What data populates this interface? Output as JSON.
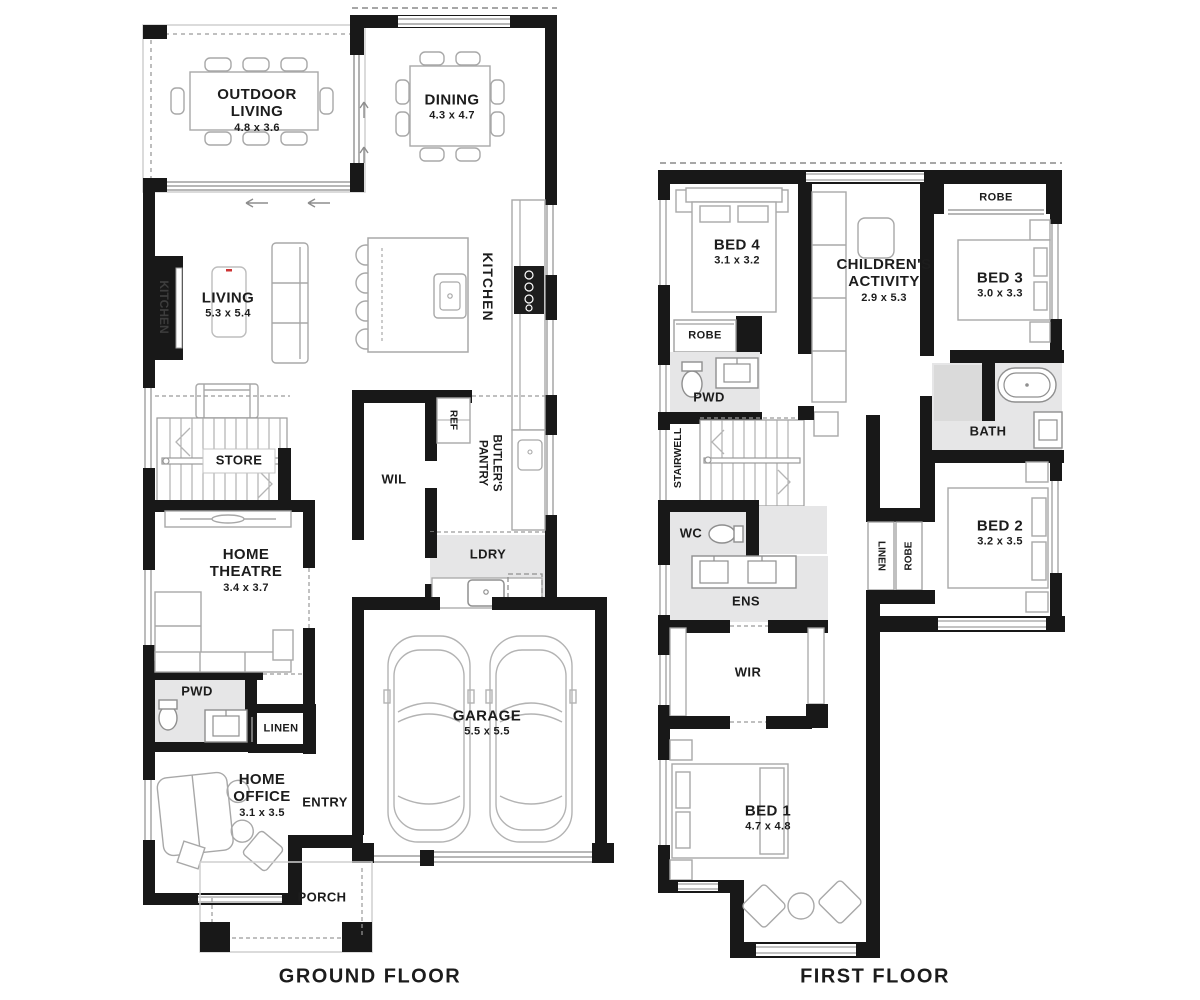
{
  "ground_floor": {
    "title": "GROUND FLOOR",
    "rooms": {
      "outdoor_living": {
        "name": "OUTDOOR LIVING",
        "dims": "4.8 x 3.6"
      },
      "dining": {
        "name": "DINING",
        "dims": "4.3 x 4.7"
      },
      "living": {
        "name": "LIVING",
        "dims": "5.3 x 5.4"
      },
      "kitchen": {
        "name": "KITCHEN"
      },
      "kitchen_feature": {
        "name": "KITCHEN"
      },
      "store": {
        "name": "STORE"
      },
      "wil": {
        "name": "WIL"
      },
      "ref": {
        "name": "REF"
      },
      "butlers_pantry": {
        "name": "BUTLER'S PANTRY"
      },
      "ldry": {
        "name": "LDRY"
      },
      "home_theatre": {
        "name": "HOME THEATRE",
        "dims": "3.4 x 3.7"
      },
      "pwd": {
        "name": "PWD"
      },
      "linen": {
        "name": "LINEN"
      },
      "home_office": {
        "name": "HOME OFFICE",
        "dims": "3.1 x 3.5"
      },
      "entry": {
        "name": "ENTRY"
      },
      "garage": {
        "name": "GARAGE",
        "dims": "5.5 x 5.5"
      },
      "porch": {
        "name": "PORCH"
      }
    }
  },
  "first_floor": {
    "title": "FIRST FLOOR",
    "rooms": {
      "bed4": {
        "name": "BED 4",
        "dims": "3.1 x 3.2"
      },
      "childrens_activity": {
        "name": "CHILDREN'S ACTIVITY",
        "dims": "2.9 x 5.3"
      },
      "robe_bed3": {
        "name": "ROBE"
      },
      "bed3": {
        "name": "BED 3",
        "dims": "3.0 x 3.3"
      },
      "robe_bed4": {
        "name": "ROBE"
      },
      "pwd": {
        "name": "PWD"
      },
      "stairwell": {
        "name": "STAIRWELL"
      },
      "bath": {
        "name": "BATH"
      },
      "wc": {
        "name": "WC"
      },
      "ens": {
        "name": "ENS"
      },
      "linen": {
        "name": "LINEN"
      },
      "robe_bed2": {
        "name": "ROBE"
      },
      "bed2": {
        "name": "BED 2",
        "dims": "3.2 x 3.5"
      },
      "wir": {
        "name": "WIR"
      },
      "bed1": {
        "name": "BED 1",
        "dims": "4.7 x 4.8"
      }
    }
  },
  "colors": {
    "wall": "#181818",
    "room_fill": "#e6e6e7",
    "furniture_stroke": "#a8a8a8",
    "text": "#1c1c1c"
  }
}
